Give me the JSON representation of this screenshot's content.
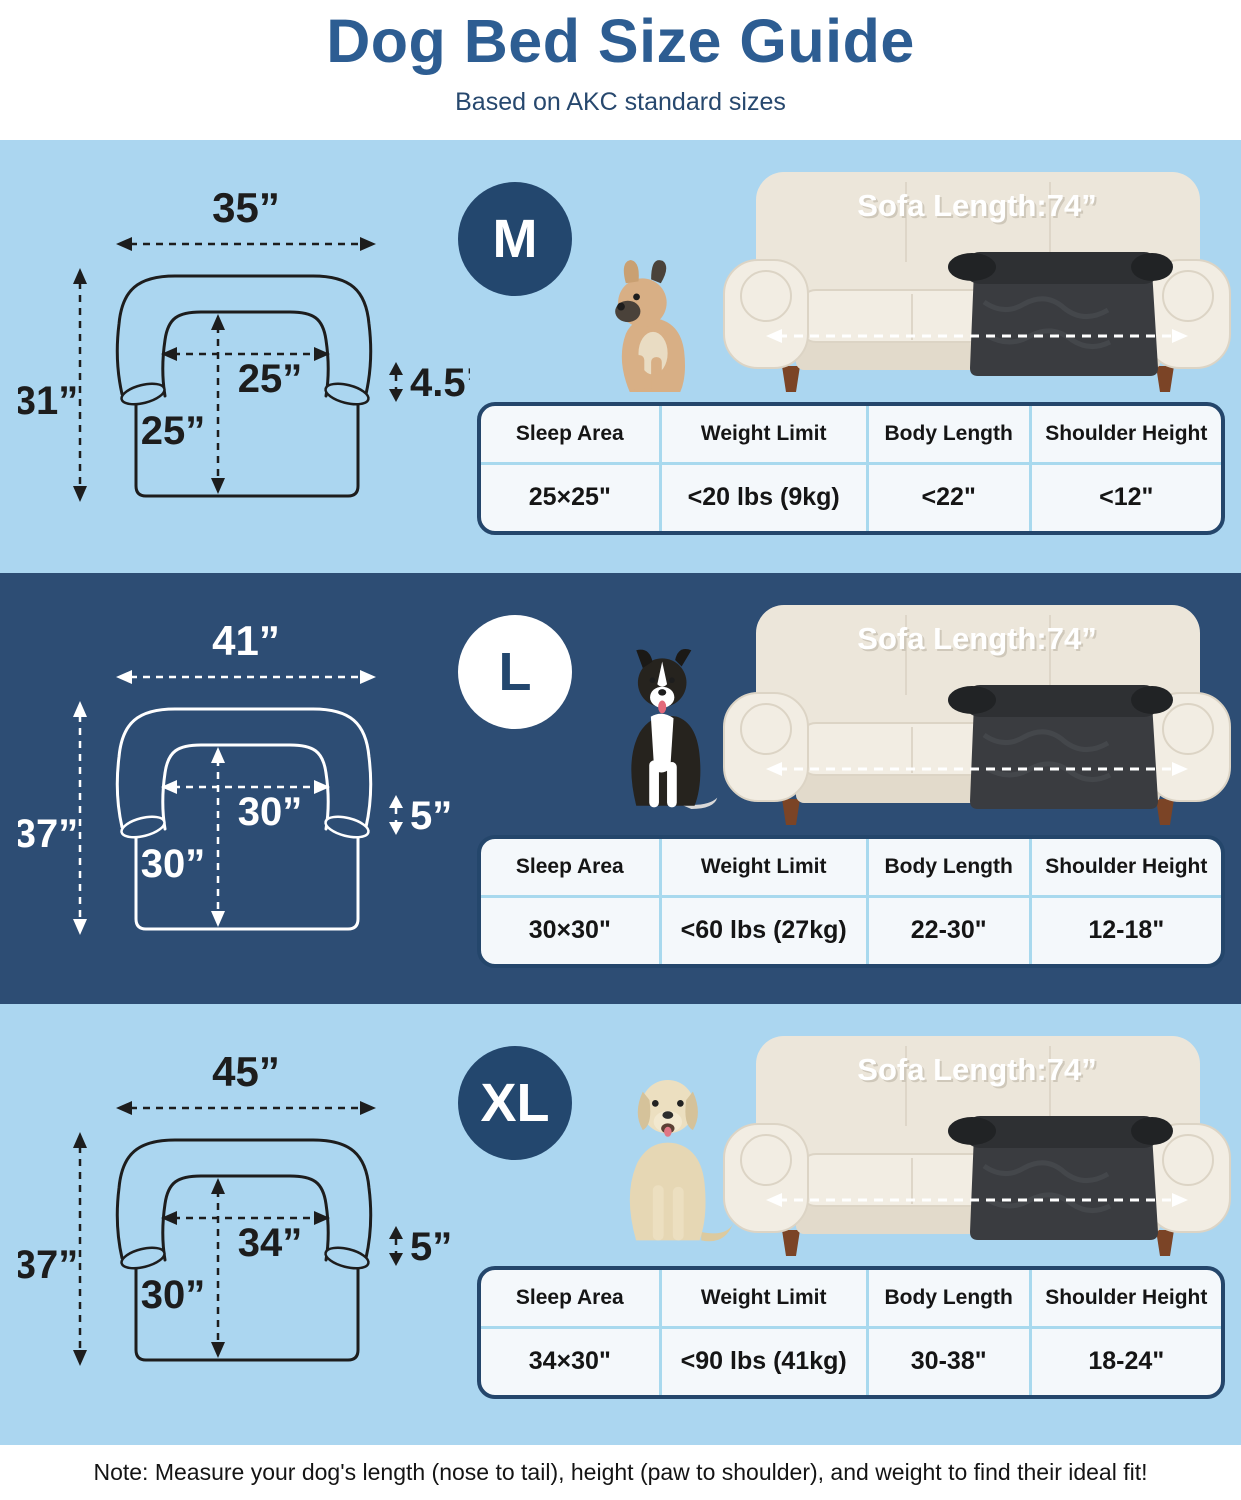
{
  "header": {
    "title": "Dog Bed Size Guide",
    "subtitle": "Based on AKC standard sizes"
  },
  "colors": {
    "light_section_bg": "#abd6f0",
    "dark_section_bg": "#2d4d74",
    "title_color": "#2d5d92",
    "subtitle_color": "#27486e",
    "badge_navy": "#23476e",
    "table_border": "#24466b",
    "table_bg": "#f4f8fb",
    "table_divider": "#a8d9ee",
    "ink_dark": "#1d1d1d",
    "sofa_cream": "#ece6da",
    "bed_dark": "#3a3c40",
    "note_color": "#141414"
  },
  "sections": [
    {
      "size_label": "M",
      "theme": "light",
      "dog": "french-bulldog",
      "dimensions": {
        "outer_width": "35”",
        "outer_height": "31”",
        "inner_width": "25”",
        "inner_depth": "25”",
        "bolster_height": "4.5”"
      },
      "sofa_label": "Sofa Length:74”",
      "table": {
        "headers": [
          "Sleep Area",
          "Weight Limit",
          "Body Length",
          "Shoulder Height"
        ],
        "values": [
          "25×25\"",
          "<20 lbs (9kg)",
          "<22\"",
          "<12\""
        ]
      }
    },
    {
      "size_label": "L",
      "theme": "dark",
      "dog": "border-collie",
      "dimensions": {
        "outer_width": "41”",
        "outer_height": "37”",
        "inner_width": "30”",
        "inner_depth": "30”",
        "bolster_height": "5”"
      },
      "sofa_label": "Sofa Length:74”",
      "table": {
        "headers": [
          "Sleep Area",
          "Weight Limit",
          "Body Length",
          "Shoulder Height"
        ],
        "values": [
          "30×30\"",
          "<60 lbs (27kg)",
          "22-30\"",
          "12-18\""
        ]
      }
    },
    {
      "size_label": "XL",
      "theme": "light",
      "dog": "labrador",
      "dimensions": {
        "outer_width": "45”",
        "outer_height": "37”",
        "inner_width": "34”",
        "inner_depth": "30”",
        "bolster_height": "5”"
      },
      "sofa_label": "Sofa Length:74”",
      "table": {
        "headers": [
          "Sleep Area",
          "Weight Limit",
          "Body Length",
          "Shoulder Height"
        ],
        "values": [
          "34×30\"",
          "<90 lbs (41kg)",
          "30-38\"",
          "18-24\""
        ]
      }
    }
  ],
  "note": "Note: Measure your dog's length (nose to tail), height (paw to shoulder), and weight to find their ideal fit!"
}
